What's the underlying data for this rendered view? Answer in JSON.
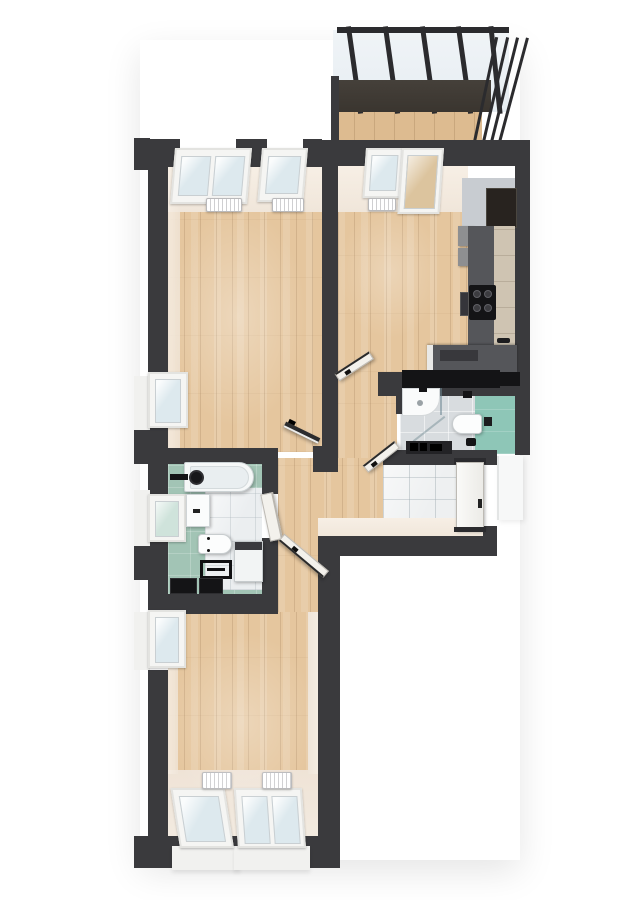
{
  "scene": {
    "type": "3d-floor-plan-render",
    "view": "top-down-isometric",
    "background": "#ffffff",
    "visible_text": "none"
  },
  "colors": {
    "wall": "#3a3a3d",
    "wallDark": "#2b2b2e",
    "woodBase": "#e5c69e",
    "deckWood": "#ddbb90",
    "cream": "#f0e6da",
    "tile": "#eef0f1",
    "marble": "#ebeef0",
    "tealBath": "#a2c4b5",
    "tealWc": "#8ec6b7",
    "grayTile": "#d8dcdf",
    "counterGray": "#55565a",
    "counterFace": "#cfc4b2",
    "cabinetDark": "#28231f",
    "upperCab": "#8e8f91",
    "wallFaceGray": "#c8ccd1",
    "black": "#141416",
    "frameWhite": "#f5f5f3",
    "glass": "#dde9ee",
    "glassGreen": "#cfe3db",
    "doorWhite": "#f3f1ec",
    "doorDark": "#2c2c2e",
    "radiator": "#ededee",
    "landing": "#f7f8f8",
    "balconyFascia": "#3a352f",
    "sill": "#f1f1ef"
  },
  "rooms": [
    {
      "id": "balcony",
      "name": "balcony",
      "floor": "wood-deck",
      "fixtures": [
        "glass-roof",
        "roof-rafters",
        "railing-posts",
        "fascia-beam"
      ]
    },
    {
      "id": "living-room",
      "name": "living room",
      "floor": "wood",
      "fixtures": [
        "double-window",
        "single-window",
        "radiator",
        "radiator",
        "side-window",
        "dark-door"
      ]
    },
    {
      "id": "kitchen",
      "name": "kitchen",
      "floor": "wood",
      "fixtures": [
        "window",
        "balcony-door",
        "radiator",
        "tall-cabinet",
        "upper-cabinets",
        "counter-run",
        "cooktop",
        "oven",
        "sink-faucet",
        "island-counter",
        "white-door"
      ]
    },
    {
      "id": "wc-bathroom",
      "name": "shower bathroom",
      "floor": "gray-tile-and-teal",
      "fixtures": [
        "shower-tray",
        "shower-glass",
        "toilet",
        "flush-plate",
        "toilet-brush",
        "black-shelf",
        "white-door"
      ]
    },
    {
      "id": "entrance-hall",
      "name": "entrance hall",
      "floor": "tile",
      "fixtures": [
        "entrance-door",
        "exterior-landing"
      ]
    },
    {
      "id": "hallway",
      "name": "hallway",
      "floor": "wood",
      "fixtures": []
    },
    {
      "id": "bathroom",
      "name": "bathroom",
      "floor": "teal-and-marble",
      "fixtures": [
        "bathtub",
        "black-faucet",
        "black-stool",
        "vanity-sink",
        "toilet",
        "washing-machine",
        "towel-rack",
        "black-mats",
        "side-window",
        "white-door"
      ]
    },
    {
      "id": "bedroom",
      "name": "bedroom",
      "floor": "wood",
      "fixtures": [
        "single-window",
        "double-window",
        "radiator",
        "radiator",
        "side-window",
        "white-door"
      ]
    }
  ],
  "counts": {
    "windows": 9,
    "doors": 6,
    "radiators": 5,
    "toilets": 2
  }
}
